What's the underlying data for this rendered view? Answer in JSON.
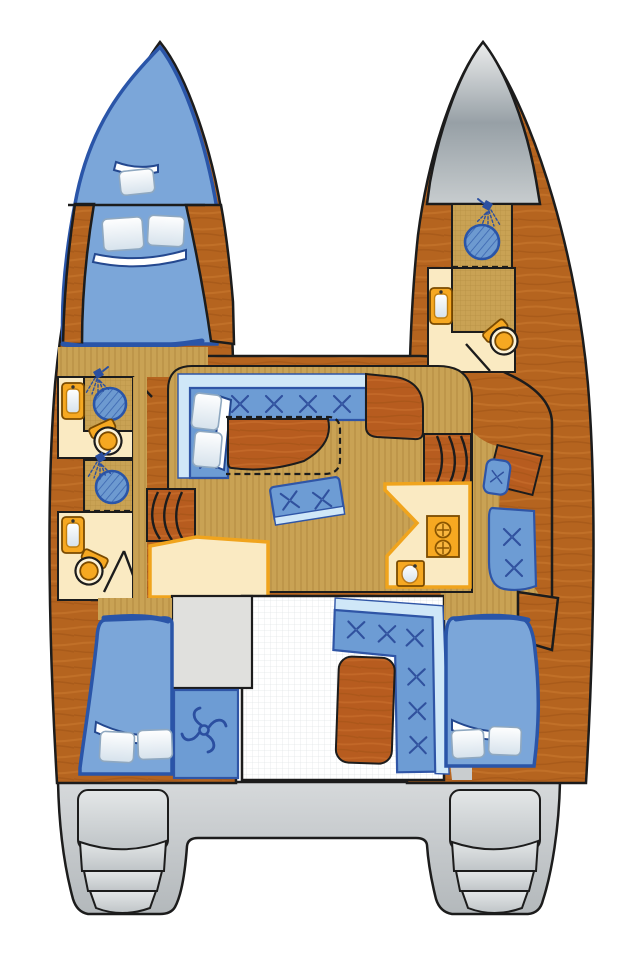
{
  "diagram": {
    "type": "catamaran-deck-plan",
    "orientation": "bow-up"
  },
  "colors": {
    "page_bg": "#ffffff",
    "outline": "#1c1c1c",
    "hull_wood": "#b5641f",
    "hull_wood_light": "#c97a30",
    "hull_wood_dark": "#9e5115",
    "furn_wood": "#b75c1f",
    "furn_wood_light": "#cc7330",
    "floor_tan": "#c9a254",
    "floor_stripe": "#a57f33",
    "cream": "#faeac2",
    "counter_edge": "#f0a41d",
    "fixture_orange": "#f6a821",
    "fixture_inner": "#fdf3d8",
    "berth_blue": "#7ba6d9",
    "berth_edge": "#2a55a8",
    "cushion_blue": "#6d9cd4",
    "cushion_edge": "#2f55a6",
    "backrest_blue": "#cfe7f8",
    "tuft_navy": "#30519e",
    "shower_blue": "#6d9ad0",
    "shower_hatch": "#3b66b0",
    "bow_gray_dark": "#97a0a6",
    "bow_gray_light": "#eceded",
    "deck_gray": "#c9cdcf",
    "step_gray": "#d8dbdd",
    "panel_gray": "#e0e0dd",
    "cockpit_white": "#ffffff",
    "cockpit_grid": "#e3e6e8",
    "pillow_edge": "#8fa8c0",
    "icon_navy": "#2b4fa0"
  },
  "features": {
    "port_hull": [
      "v-berth",
      "double-berth",
      "forward-head-with-shower",
      "aft-head-with-shower",
      "aft-double-berth"
    ],
    "starboard_hull": [
      "bow-locker",
      "shower-room",
      "head-with-washbasin",
      "nav-desk-with-seat",
      "aft-double-berth"
    ],
    "bridgedeck": [
      "l-shaped-settee",
      "salon-table",
      "movable-bench",
      "galley-two-burner-stove",
      "galley-sink",
      "steps-to-port-hull",
      "steps-to-starboard-hull"
    ],
    "cockpit": [
      "l-shaped-cockpit-seat",
      "cockpit-table",
      "engine-hatch",
      "helm-propeller-panel"
    ],
    "stern": [
      "transom-steps-port",
      "transom-steps-starboard",
      "swim-platforms"
    ]
  },
  "icons": {
    "shower": "shower-head-icon",
    "propeller": "propeller-icon",
    "button_tuft": "cushion-tuft-icon",
    "burner": "stove-burner-icon"
  }
}
